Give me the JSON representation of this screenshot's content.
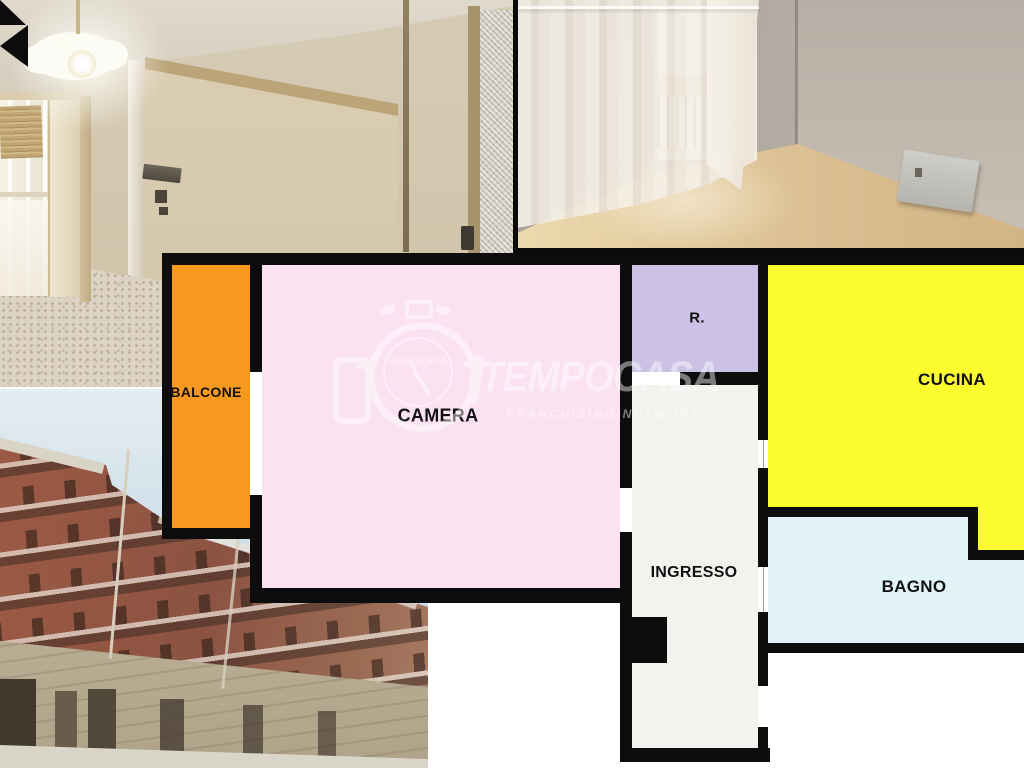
{
  "collage": {
    "floorplan": {
      "rooms": {
        "balcone": {
          "label": "BALCONE",
          "color": "#f7981f"
        },
        "camera": {
          "label": "CAMERA",
          "color": "#fae2f0"
        },
        "ripostiglio": {
          "label": "R.",
          "color": "#cbc2e6"
        },
        "cucina": {
          "label": "CUCINA",
          "color": "#fbfb2d"
        },
        "ingresso": {
          "label": "INGRESSO",
          "color": "#f2f2ee"
        },
        "bagno": {
          "label": "BAGNO",
          "color": "#e2f4fa"
        }
      },
      "wall_color": "#0d0d0d",
      "entrance_arrow_direction": "left"
    },
    "watermark": {
      "brand": "TEMPOCASA",
      "logo_text": "TEMPOCASA",
      "tagline": "FRANCHISING NETWORK"
    }
  }
}
